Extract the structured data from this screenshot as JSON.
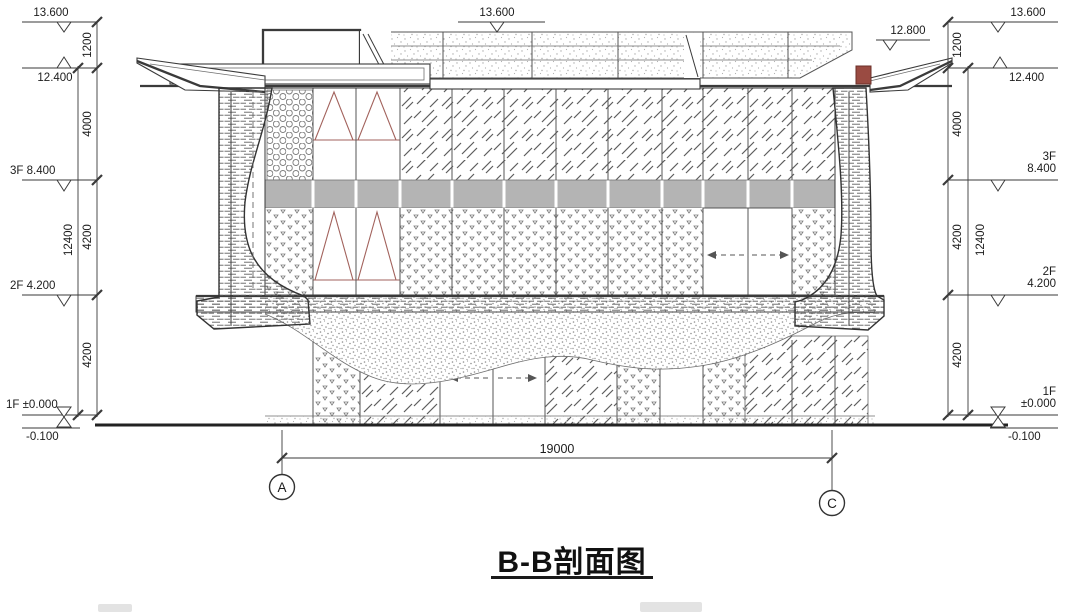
{
  "title": "B-B剖面图",
  "colors": {
    "line": "#3a3a3a",
    "accent-red": "#a2625c",
    "slab-gray": "#b4b4b4",
    "paper": "#ffffff"
  },
  "left_column": {
    "level_13600": "13.600",
    "dim_1200": "1200",
    "level_12400": "12.400",
    "dim_4000": "4000",
    "floor_3": "3F",
    "level_8400": "8.400",
    "dim_4200_upper": "4200",
    "dim_total": "12400",
    "floor_2": "2F",
    "level_4200": "4.200",
    "dim_4200_lower": "4200",
    "floor_1": "1F",
    "level_0000": "±0.000",
    "level_minus": "-0.100"
  },
  "right_column": {
    "level_13600": "13.600",
    "dim_1200": "1200",
    "level_12800": "12.800",
    "level_12400": "12.400",
    "dim_4000": "4000",
    "floor_3": "3F",
    "level_8400": "8.400",
    "dim_4200_upper": "4200",
    "dim_total": "12400",
    "floor_2": "2F",
    "level_4200": "4.200",
    "dim_4200_lower": "4200",
    "floor_1": "1F",
    "level_0000": "±0.000",
    "level_minus": "-0.100"
  },
  "roof": {
    "level_13600": "13.600"
  },
  "bottom": {
    "span_dim": "19000",
    "grid_a": "A",
    "grid_c": "C"
  }
}
